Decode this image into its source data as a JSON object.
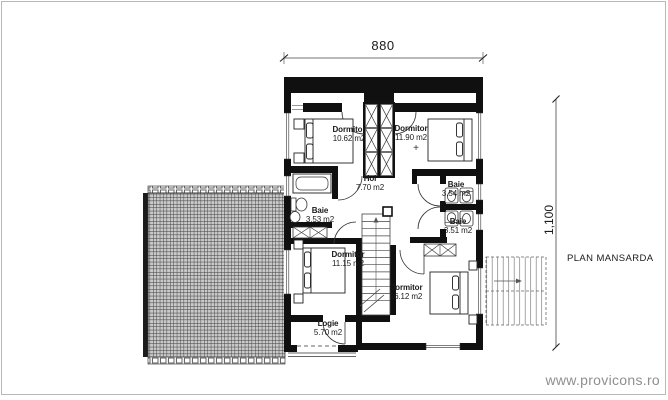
{
  "plan": {
    "title": "PLAN MANSARDA",
    "watermark": "www.provicons.ro",
    "level_marker": "+",
    "dimensions": {
      "width": "880",
      "height": "1,100"
    },
    "rooms": [
      {
        "name": "Dormitor",
        "area": "10.62 m2"
      },
      {
        "name": "Dormitor",
        "area": "11.90 m2"
      },
      {
        "name": "Hol",
        "area": "7.70 m2"
      },
      {
        "name": "Baie",
        "area": "3.54 m2"
      },
      {
        "name": "Baie",
        "area": "3.53 m2"
      },
      {
        "name": "Baie",
        "area": "3.51 m2"
      },
      {
        "name": "Dormitor",
        "area": "11.15 m2"
      },
      {
        "name": "Dormitor",
        "area": "16.12 m2"
      },
      {
        "name": "Logie",
        "area": "5.70 m2"
      }
    ]
  }
}
